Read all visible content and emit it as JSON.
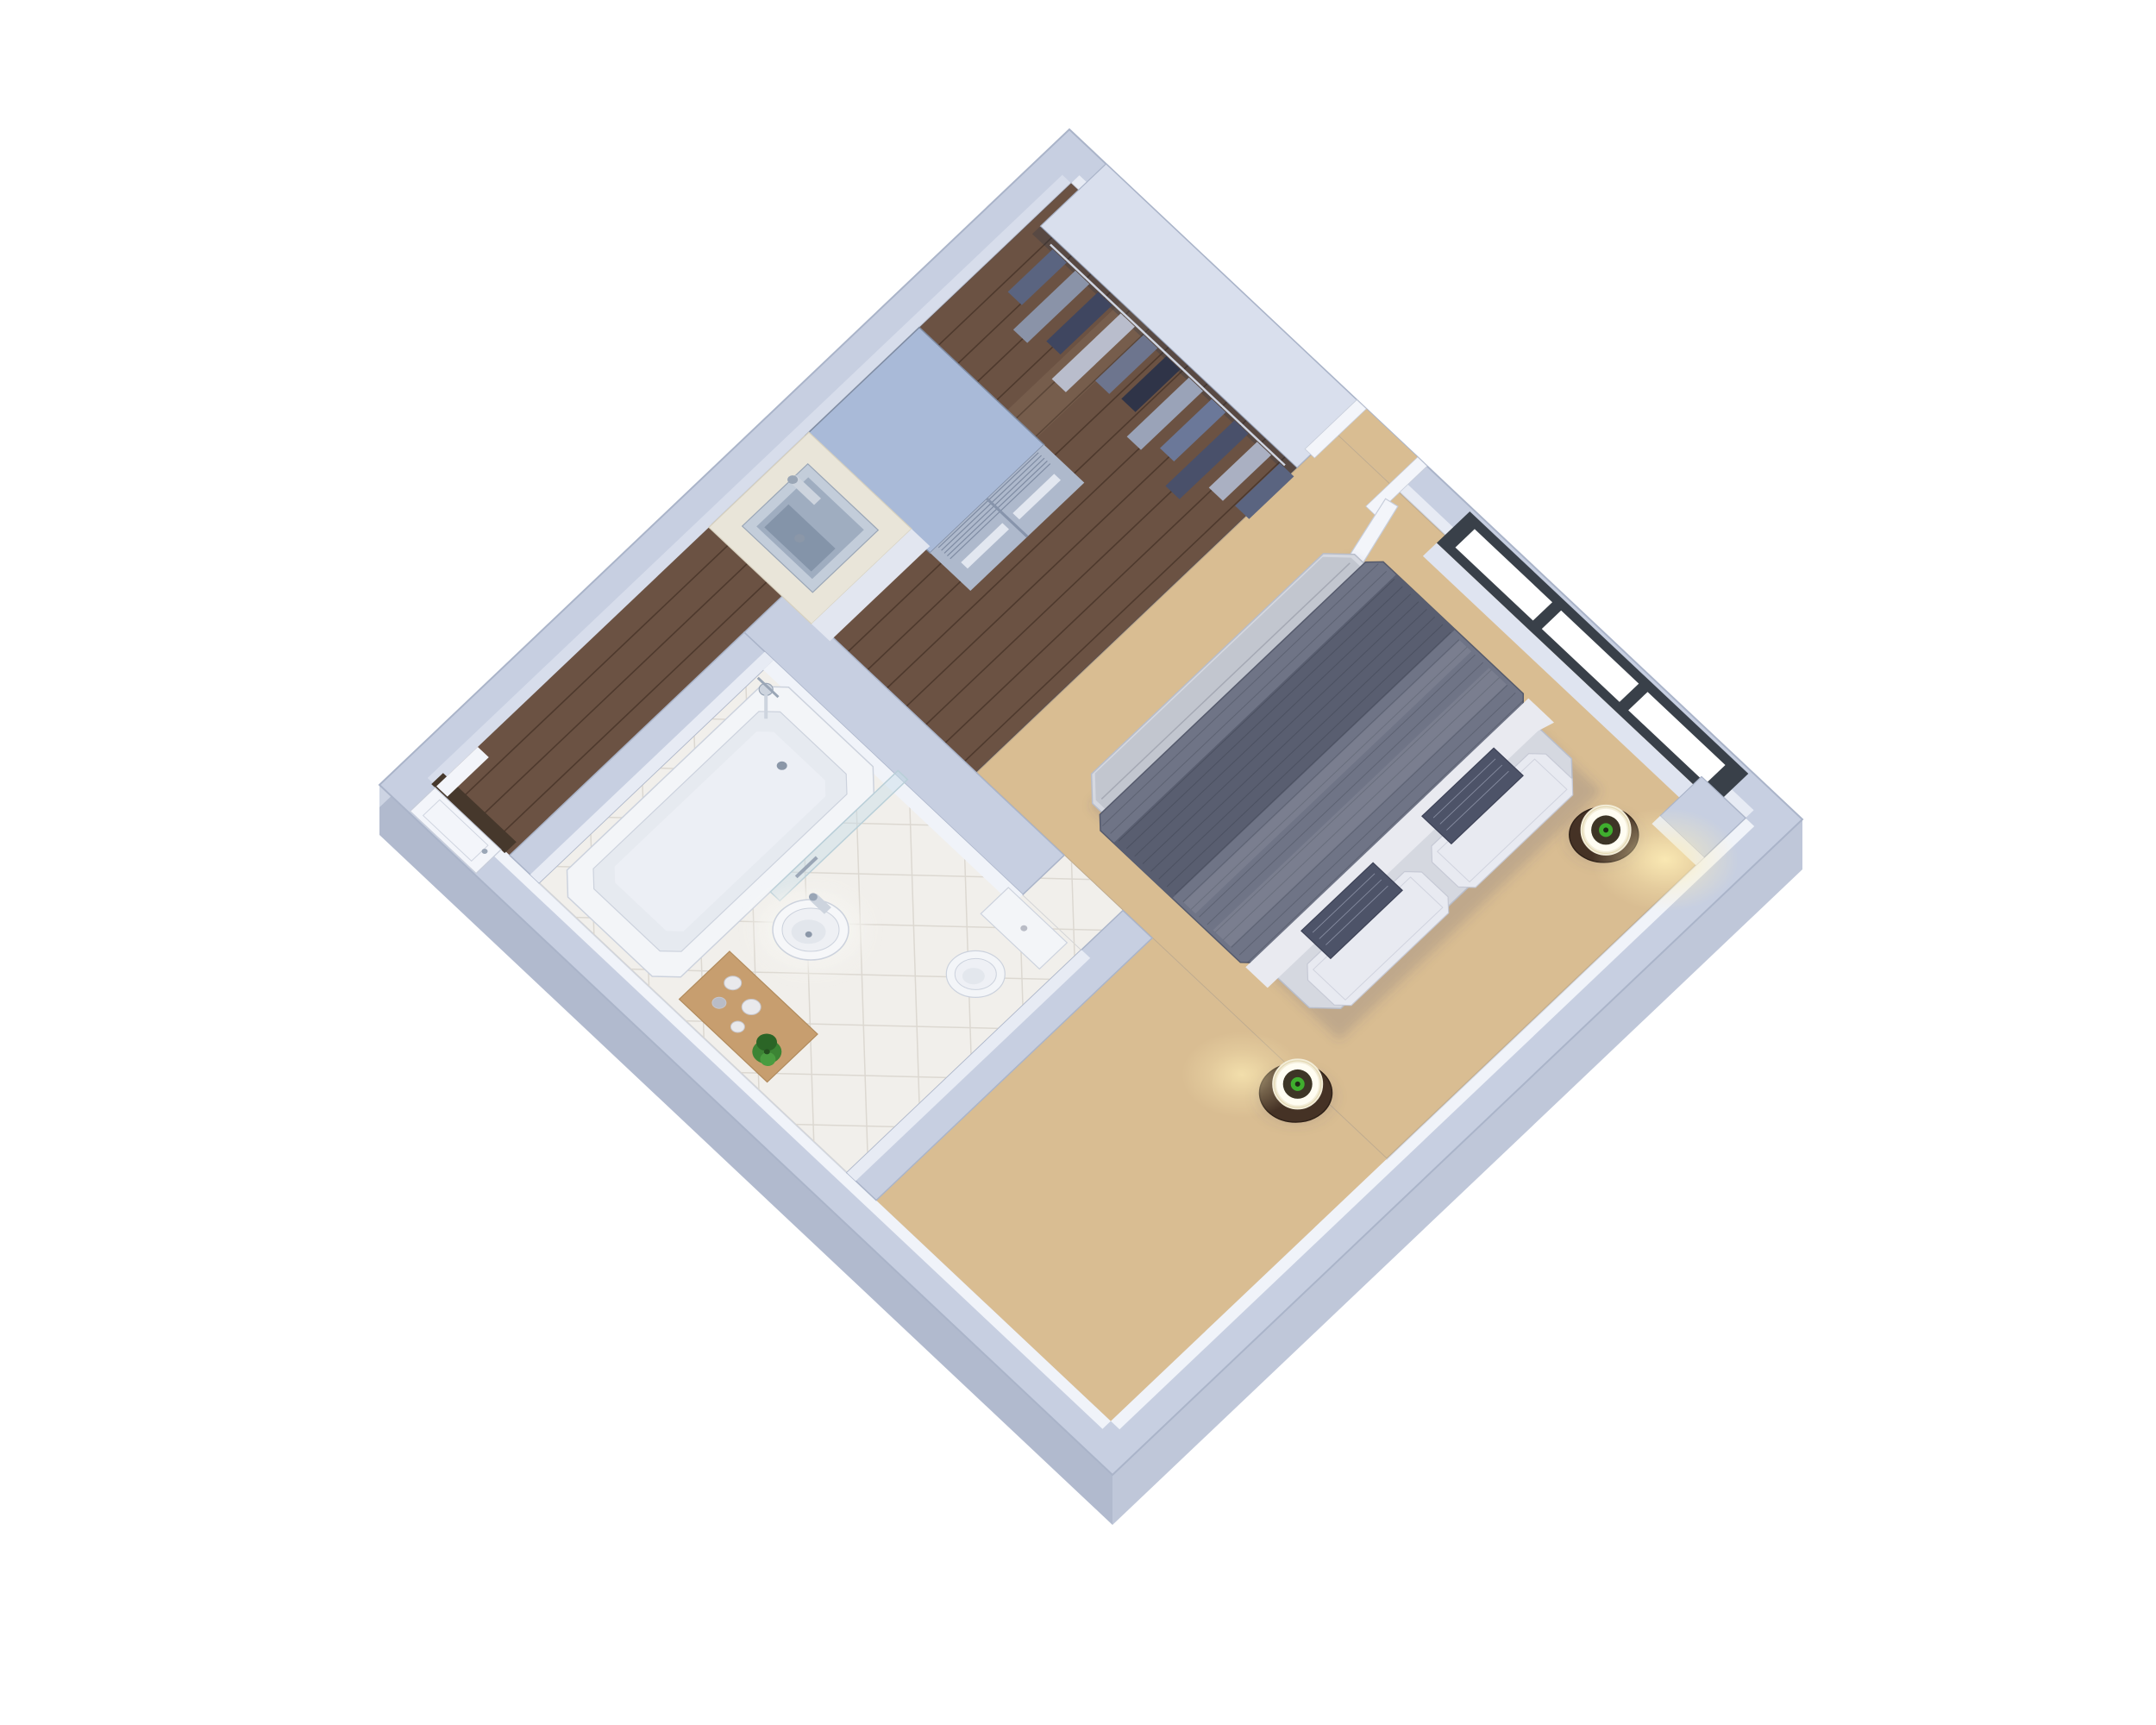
{
  "scene": {
    "kind": "3d-floor-plan-render",
    "subject": "studio apartment viewed top-down at an angle",
    "background": "#ffffff",
    "rooms": [
      "kitchen",
      "bedroom",
      "bathroom",
      "entry-hall",
      "closet"
    ],
    "counts": {
      "window_panes": 3,
      "pillows_white": 2,
      "pillows_accent": 2,
      "lamps": 2,
      "nightstands": 2,
      "hanging_garments": 10,
      "toiletry_jars": 4
    }
  },
  "palette": {
    "bg": "#ffffff",
    "wallTop": "#c7cfe1",
    "closetTop": "#d9dfed",
    "wallEdge": "#aab4c9",
    "wallInnerFace": "#e7ebf4",
    "wallInnerShade": "#d7ddeb",
    "wallInnerBright": "#f0f3f9",
    "wallSkirtSW": "#b1bace",
    "wallSkirtSE": "#bfc7d9",
    "wallSkirtNW": "#cdd4e3",
    "floorWood": "#6b5243",
    "woodSeam": "rgba(32,19,10,0.38)",
    "woodStreak": "rgba(255,226,190,0.08)",
    "floorCarpet": "#d9bd92",
    "floorTile": "#f1efeb",
    "tileLine": "#dcd8d1",
    "aoLine": "rgba(70,80,105,0.16)",
    "windowFrame": "#394049",
    "windowPane": "#ffffff",
    "sillLight": "#dfe4f0",
    "fridgeTop": "#a9bad8",
    "fridgeFront": "#aeb9cc",
    "fridgeHandle": "#e2e7f0",
    "fridgeGrille": "#7e8ba2",
    "fridgeDivider": "#8794ab",
    "counterTop": "#e9e5d9",
    "counterEdge": "#d6d0bf",
    "counterFront": "#e2e6f0",
    "sinkRim": "#c3cdda",
    "sinkBasin": "#9fadc0",
    "sinkDeep": "#8494a9",
    "faucet": "#cdd4de",
    "chromeDark": "#9aa6b6",
    "closetShadow": "rgba(40,50,70,0.28)",
    "clothes": [
      "#5a6480",
      "#8a93a8",
      "#3f4660",
      "#b9bdcc",
      "#6d758e",
      "#2f3448",
      "#9aa3b8",
      "#6b7899",
      "#49506a",
      "#aab0c2"
    ],
    "rodChrome": "#cfd5e2",
    "doorWhite": "#f3f5fa",
    "doorEdge": "#c7cdda",
    "thresholdDark": "#46382c",
    "bedMattress": "#d5d8e0",
    "bedMattressEdge": "#b8bdca",
    "bedSheetSilver": "#c2c6cf",
    "sheetFoldLine": "rgba(90,95,110,0.28)",
    "duvet": "#6f7486",
    "duvetDark": "#595e70",
    "duvetEdge": "#555a6c",
    "duvetLine": "rgba(25,28,38,0.20)",
    "duvetWrinkle": "rgba(255,255,255,0.08)",
    "sheetWhite": "#e9eaf0",
    "pillowWhite": "#e8eaf1",
    "pillowEdge": "#c6c9d5",
    "pillowAccent": "#4d5368",
    "pillowAccentEdge": "#3c4156",
    "pillowAccentLine": "#9ba1b5",
    "nightstand": "#453225",
    "nightstandEdge": "#2f2118",
    "lampShade": "#f3edd8",
    "lampShadeEdge": "#e4d9b4",
    "lampTop": "#fffdf2",
    "lampInner": "#3d3526",
    "lampGreen": "#3fae2e",
    "lampGreenDark": "#1f2a16",
    "glowWarm": "#ffefb8",
    "bathWhite": "#f3f5f8",
    "bathEdge": "#ccd2dd",
    "tubInner": "#e6eaf0",
    "tubFloor": "#eceff5",
    "drainMetal": "#8b97a8",
    "toiletSeat": "#eef0f5",
    "toiletHole": "#e3e7ed",
    "glass": "rgba(200,222,232,0.45)",
    "glassEdge": "#b9cfd8",
    "basinWhite": "#f6f7f9",
    "basinInner": "#eef0f4",
    "basinWell": "#e2e6ec",
    "matWhite": "#f5f4f0",
    "trayWood": "#c79e6f",
    "trayEdge": "#b08a5c",
    "jarWhite": "#e9e9ec",
    "jarGray": "#b9bcc6",
    "jarEdge": "#c6c6cd",
    "plantGreen": "#3c8434",
    "plantDark": "#2b6526",
    "plantLight": "#4a9c40",
    "plantCore": "#244f1f",
    "shadow": "rgba(70,80,105,0.18)",
    "shadowSoft": "rgba(70,80,105,0.10)"
  }
}
